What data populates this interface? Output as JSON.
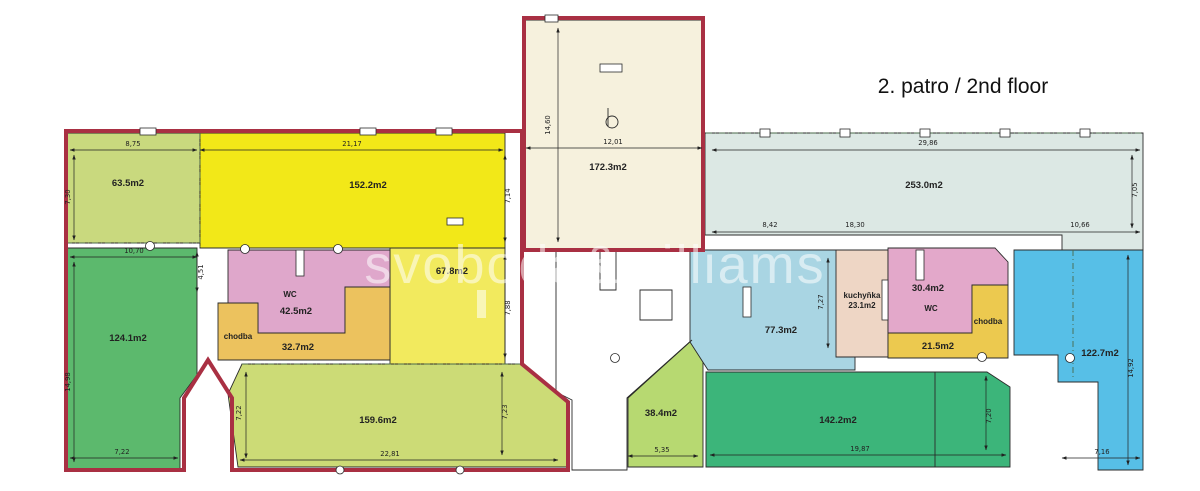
{
  "title": "2. patro / 2nd floor",
  "watermark": "svoboda&williams",
  "colors": {
    "outline_red": "#a93043",
    "wall": "#2b2b2b",
    "c63": "#c9d97e",
    "c152": "#f2e818",
    "c67": "#f2ea5e",
    "cwc": "#dfa7cb",
    "cchodba": "#ecc25e",
    "c124": "#5cb96d",
    "c159": "#ccdb76",
    "c172": "#f6f1dd",
    "c38": "#b7d971",
    "c253": "#dce8e4",
    "c77": "#a9d5e3",
    "ckuch": "#eed6c5",
    "c30": "#e3a8ca",
    "cyellowR": "#ecc94f",
    "c142": "#3cb57a",
    "c122": "#57bfe7"
  },
  "rooms": {
    "r63": {
      "area": "63.5m2"
    },
    "r152": {
      "area": "152.2m2"
    },
    "r67": {
      "area": "67.8m2"
    },
    "wcL": {
      "name": "WC",
      "area": "42.5m2"
    },
    "chodbaL": {
      "name": "chodba"
    },
    "r32": {
      "area": "32.7m2"
    },
    "r124": {
      "area": "124.1m2"
    },
    "r159": {
      "area": "159.6m2"
    },
    "r172": {
      "area": "172.3m2"
    },
    "r38": {
      "area": "38.4m2"
    },
    "r253": {
      "area": "253.0m2"
    },
    "r77": {
      "area": "77.3m2"
    },
    "kuch": {
      "name": "kuchyňka",
      "area": "23.1m2"
    },
    "r30": {
      "area": "30.4m2",
      "name": "WC"
    },
    "chodbaR": {
      "name": "chodba"
    },
    "r21": {
      "area": "21.5m2"
    },
    "r142": {
      "area": "142.2m2"
    },
    "r122": {
      "area": "122.7m2"
    }
  },
  "dims": {
    "w63top": "8,75",
    "w152top": "21,17",
    "h63left": "7,30",
    "w124top": "10,70",
    "h451": "4,51",
    "h124left": "14,98",
    "w124bottom": "7,22",
    "h714": "7,14",
    "h788": "7,88",
    "h159left": "7,22",
    "h159right": "7,23",
    "w159bottom": "22,81",
    "w38bottom": "5,35",
    "h172left": "14,60",
    "w172": "12,01",
    "w253top": "29,86",
    "h253right": "7,05",
    "w842": "8,42",
    "w1830": "18,30",
    "w1066": "10,66",
    "h727": "7,27",
    "w142bottom": "19,87",
    "h142right": "7,20",
    "h122right": "14,92",
    "w122bottom": "7,16"
  }
}
